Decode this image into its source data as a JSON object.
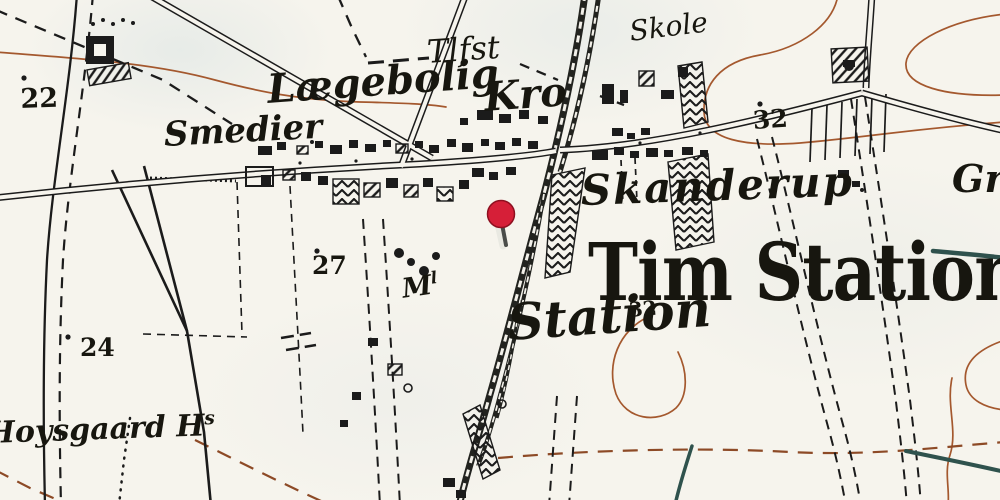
{
  "map": {
    "region_title": "Tim Station",
    "labels": {
      "tlfst": "Tlfst",
      "skole": "Skole",
      "laegebolig": "Lægebolig",
      "kro": "Kro",
      "smedier": "Smedier",
      "skanderup": "Skanderup",
      "tim_station": "Tim Station",
      "station": "Station",
      "moelle": "M",
      "moelle_sup": "l",
      "hoysgaard": "Hoysgaard H",
      "hoysgaard_sup": "s",
      "gaard_partial": "Gr"
    },
    "numbers": {
      "n22": "22",
      "n32_top": "32",
      "n27": "27",
      "n24": "24",
      "n32_mid": "32"
    },
    "marker": {
      "name": "red-location-pin",
      "color": "#d61f38"
    },
    "colors": {
      "paper": "#f6f4ed",
      "ink": "#1b1b1b",
      "contour_brown": "#a4582e",
      "path_brown": "#8d4a26",
      "water_teal": "#2f524d",
      "pin_red": "#d61f38"
    }
  }
}
